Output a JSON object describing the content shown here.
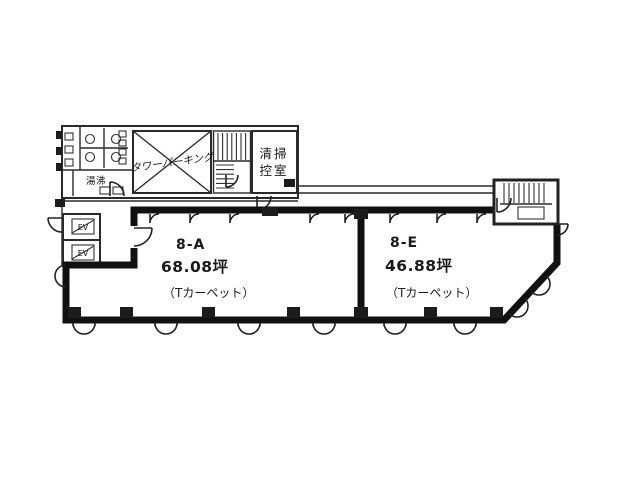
{
  "document": {
    "type": "building-floor-plan",
    "background": "#ffffff",
    "line_color": "#1a1a1a"
  },
  "units": [
    {
      "id": "8-A",
      "area": "68.08坪",
      "finish": "（Tカーペット）"
    },
    {
      "id": "8-E",
      "area": "46.88坪",
      "finish": "（Tカーペット）"
    }
  ],
  "facilities": {
    "cleaning_room_line1": "清掃",
    "cleaning_room_line2": "控室",
    "tower_parking": "タワーパーキング",
    "hot_water": "湯沸",
    "elevator": "EV"
  }
}
